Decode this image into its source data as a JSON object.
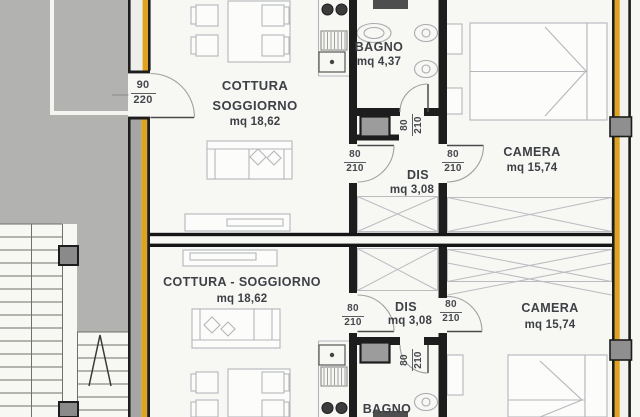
{
  "plan_type": "floor-plan",
  "rooms": {
    "top_living": {
      "name_line1": "COTTURA",
      "name_line2": "SOGGIORNO",
      "area": "mq 18,62"
    },
    "top_bath": {
      "name": "BAGNO",
      "area": "mq 4,37"
    },
    "top_hall": {
      "name": "DIS",
      "area": "mq 3,08"
    },
    "top_bedroom": {
      "name": "CAMERA",
      "area": "mq 15,74"
    },
    "bottom_living": {
      "name": "COTTURA - SOGGIORNO",
      "area": "mq 18,62"
    },
    "bottom_hall": {
      "name": "DIS",
      "area": "mq 3,08"
    },
    "bottom_bedroom": {
      "name": "CAMERA",
      "area": "mq 15,74"
    },
    "bottom_bath": {
      "name": "BAGNO"
    }
  },
  "door_sizes": {
    "entry_top": {
      "w": "90",
      "h": "220"
    },
    "top_hall_left": {
      "w": "80",
      "h": "210"
    },
    "top_hall_right": {
      "w": "80",
      "h": "210"
    },
    "top_bath": {
      "w": "80",
      "h": "210"
    },
    "bottom_hall_left": {
      "w": "80",
      "h": "210"
    },
    "bottom_hall_right": {
      "w": "80",
      "h": "210"
    },
    "bottom_bath": {
      "w": "80",
      "h": "210"
    }
  },
  "colors": {
    "accent_yellow": "#dfa31f",
    "common_area_gray": "#b2b2b0",
    "wall_black": "#1d1d1d",
    "furniture_line": "#b4b6bb"
  }
}
